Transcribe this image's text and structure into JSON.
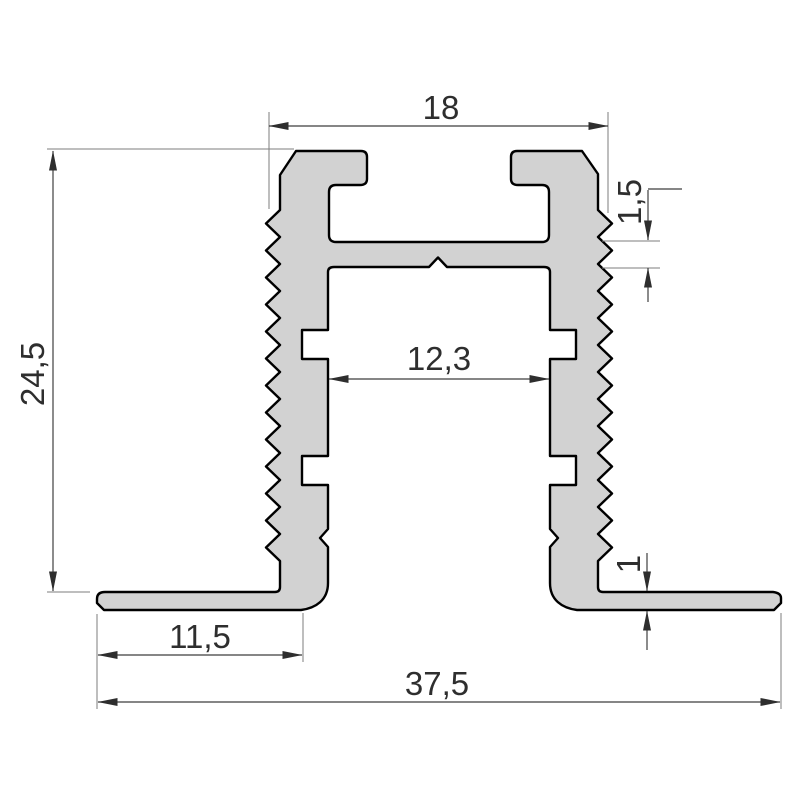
{
  "drawing": {
    "type": "profile-cross-section",
    "dimensions": {
      "top_width": {
        "label": "18"
      },
      "tooth_pitch": {
        "label": "1,5"
      },
      "overall_height": {
        "label": "24,5"
      },
      "inner_width": {
        "label": "12,3"
      },
      "flange_thickness": {
        "label": "1"
      },
      "flange_length": {
        "label": "11,5"
      },
      "overall_width": {
        "label": "37,5"
      }
    },
    "colors": {
      "background": "#ffffff",
      "profile_fill": "#d2d2d2",
      "profile_outline": "#000000",
      "dimension_line": "#3f3f3f",
      "extension_line": "#7d7d7d",
      "label_text": "#2e2e2e"
    }
  }
}
